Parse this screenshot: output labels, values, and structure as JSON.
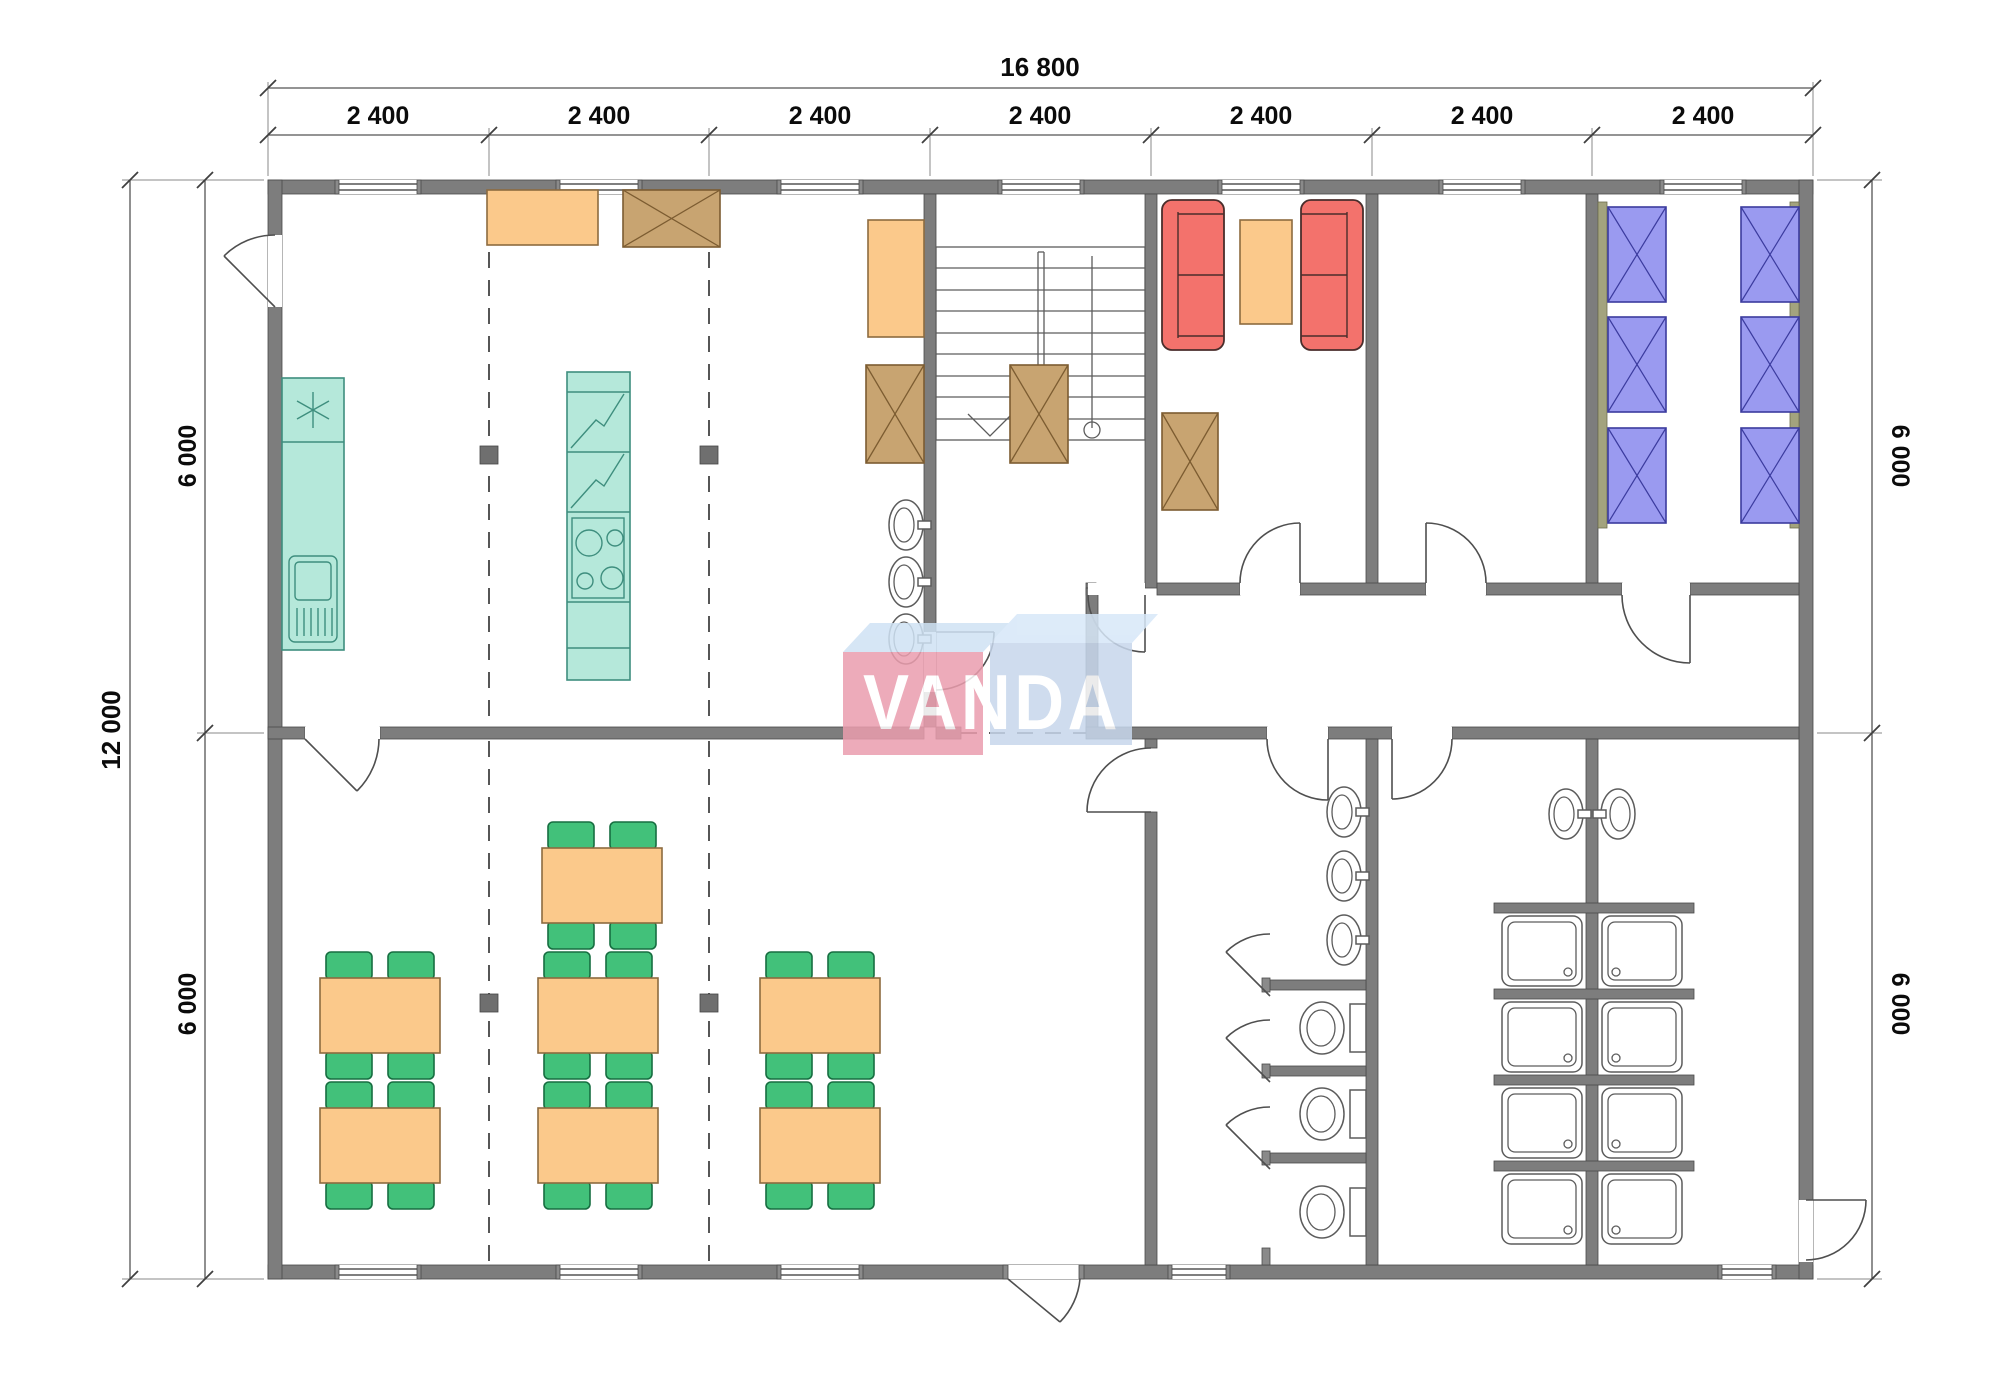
{
  "watermark": {
    "text": "VANDA",
    "red_block_color": "#eb9dae",
    "blue_block_color": "#c7d7ec"
  },
  "dimensions": {
    "top_total": "16 800",
    "top_bays": [
      "2 400",
      "2 400",
      "2 400",
      "2 400",
      "2 400",
      "2 400",
      "2 400"
    ],
    "left_total": "12 000",
    "left_segments": [
      "6 000",
      "6 000"
    ],
    "right_segments": [
      "6 000",
      "6 000"
    ]
  },
  "colors": {
    "wall": "#7d7d7d",
    "kitchen_unit": "#b5e8da",
    "table": "#fbc98b",
    "cabinet": "#c8a471",
    "chair": "#42c17a",
    "sofa": "#f3726c",
    "bed": "#9a9af0"
  },
  "rooms": [
    {
      "name": "kitchen-hall",
      "icons": [
        "entry-door-icon",
        "kitchen-counter-sink-icon",
        "dishwasher-icon",
        "refrigerator-stack-icon",
        "stove-4-burner-icon",
        "worktable-icon",
        "storage-box-icon",
        "side-table-icon",
        "wash-basin-icon",
        "wash-basin-icon",
        "wash-basin-icon"
      ]
    },
    {
      "name": "stair-hall",
      "icons": [
        "u-staircase-icon",
        "down-arrow-icon"
      ]
    },
    {
      "name": "lounge",
      "icons": [
        "sofa-icon",
        "sofa-icon",
        "coffee-table-icon",
        "storage-box-icon"
      ]
    },
    {
      "name": "spare-room",
      "icons": []
    },
    {
      "name": "bedroom",
      "icons": [
        "bed-icon",
        "bed-icon",
        "bed-icon",
        "bed-icon",
        "bed-icon",
        "bed-icon"
      ]
    },
    {
      "name": "dining-hall",
      "icons": [
        "dining-table-icon x7",
        "chair-icon x28"
      ]
    },
    {
      "name": "vestibule",
      "icons": [
        "entrance-door-icon"
      ]
    },
    {
      "name": "wc",
      "icons": [
        "wash-basin-icon x3",
        "toilet-icon x3",
        "stall-door-icon x3"
      ]
    },
    {
      "name": "shower-room",
      "icons": [
        "shower-tray-icon x8",
        "wash-basin-icon x2"
      ]
    }
  ]
}
